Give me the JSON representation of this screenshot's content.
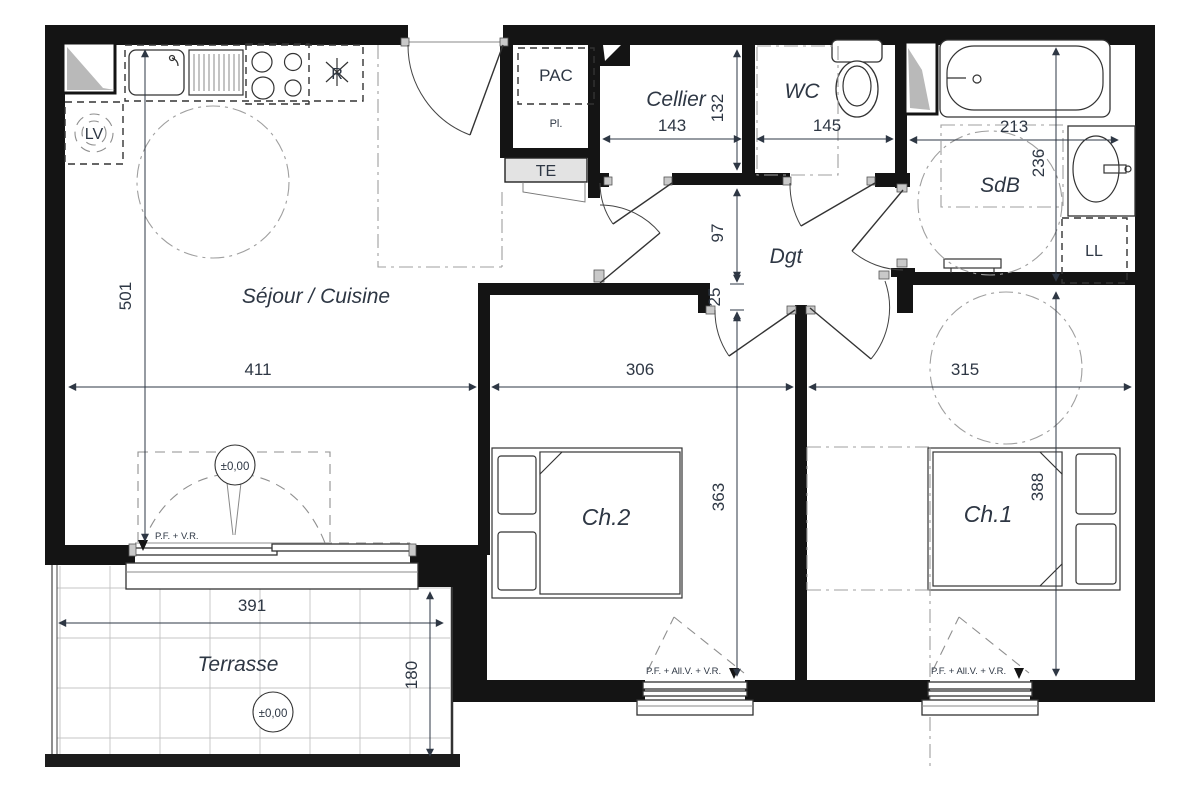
{
  "plan": {
    "rooms": {
      "sejour": "Séjour / Cuisine",
      "cellier": "Cellier",
      "wc": "WC",
      "sdb": "SdB",
      "dgt": "Dgt",
      "ch1": "Ch.1",
      "ch2": "Ch.2",
      "terrasse": "Terrasse"
    },
    "equipment": {
      "pac": "PAC",
      "placard": "Pl.",
      "tableau_electrique": "TE",
      "lave_vaisselle": "LV",
      "lave_linge": "LL",
      "refrigerateur": "R"
    },
    "levels": {
      "sejour": "±0,00",
      "terrasse": "±0,00"
    },
    "window_labels": {
      "bay": "P.F. + V.R.",
      "ch2_window": "P.F. + All.V. + V.R.",
      "ch1_window": "P.F. + All.V. + V.R."
    },
    "dimensions_cm": {
      "sejour_depth": "501",
      "sejour_width": "411",
      "ch2_width": "306",
      "ch2_depth": "363",
      "ch1_width": "315",
      "ch1_depth": "388",
      "cellier_width": "143",
      "cellier_depth": "132",
      "wc_width": "145",
      "sdb_width": "213",
      "sdb_depth": "236",
      "dgt_depth": "97",
      "dgt_wall": "25",
      "terrasse_width": "391",
      "terrasse_depth": "180"
    },
    "colors": {
      "wall": "#141414",
      "label": "#2e3744",
      "duct": "#b9b9b9"
    }
  }
}
